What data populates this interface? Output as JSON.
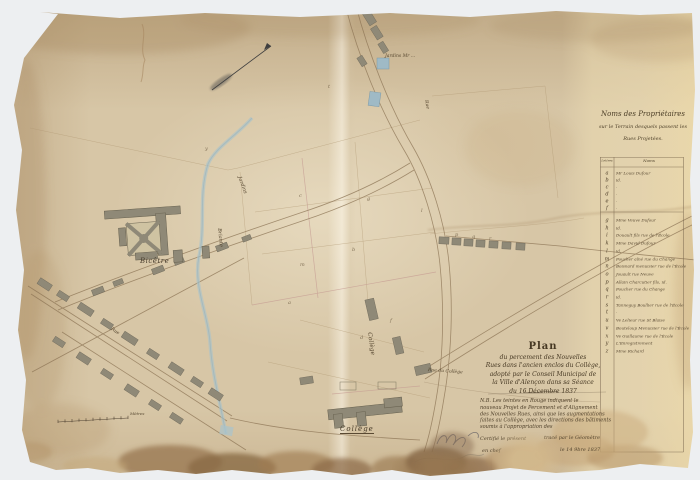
{
  "sheet": {
    "scale_label": "Mètres"
  },
  "colors": {
    "paper": "#d7c6a6",
    "ink": "#4a3c2c",
    "stream_blue": "#a9c3cc",
    "stain_brown": "#8a6a46",
    "building_gray": "#8f8977"
  },
  "title_block": {
    "l1": "Plan",
    "l2": "du percement des Nouvelles",
    "l3": "Rues dans l'ancien enclos du Collège,",
    "l4": "adopté par le Conseil Municipal de",
    "l5": "la Ville d'Alençon dans sa Séance",
    "l6": "du 16 Décembre 1837"
  },
  "note_block": {
    "lines": [
      "N.B. Les teintes en Rouge indiquent le",
      "nouveau Projet de Percement et d'Alignement",
      "des Nouvelles Rues, ainsi que les augmentations",
      "faites au Collège, avec les directions des bâtiments",
      "soumis à l'appropriation des"
    ]
  },
  "certification": {
    "l1a": "Certifié le présent",
    "l1b": "tracé par le Géomètre",
    "l2a": "en chef",
    "l2b": "le 14 9bre 1837"
  },
  "proprietors": {
    "heading1": "Noms des Propriétaires",
    "heading2": "sur le Terrain desquels passent les",
    "heading3": "Rues Projetées.",
    "col_letters": "Lettres",
    "col_names": "Noms",
    "rows": [
      {
        "letter": "a",
        "name": "Mr Louis Dufour"
      },
      {
        "letter": "b",
        "name": "id."
      },
      {
        "letter": "c",
        "name": "·"
      },
      {
        "letter": "d",
        "name": "·"
      },
      {
        "letter": "e",
        "name": "·"
      },
      {
        "letter": "f",
        "name": "·"
      },
      {
        "letter": "g",
        "name": "Mme Veuve Dufour"
      },
      {
        "letter": "h",
        "name": "id."
      },
      {
        "letter": "i",
        "name": "Douault fils rue de l'École"
      },
      {
        "letter": "k",
        "name": "Mme David Dufour"
      },
      {
        "letter": "l",
        "name": "id."
      },
      {
        "letter": "m",
        "name": "Foucher aîné rue du Change"
      },
      {
        "letter": "n",
        "name": "Boisnard menuisier rue de l'École"
      },
      {
        "letter": "o",
        "name": "Jouault rue Neuve"
      },
      {
        "letter": "p",
        "name": "Allain Charcutier fils, id."
      },
      {
        "letter": "q",
        "name": "Foucher rue du Change"
      },
      {
        "letter": "r",
        "name": "id."
      },
      {
        "letter": "s",
        "name": "Tanneguy Boullier rue de l'École"
      },
      {
        "letter": "t",
        "name": "·"
      },
      {
        "letter": "u",
        "name": "Ve Lelieur rue St Blaise"
      },
      {
        "letter": "v",
        "name": "Bouteloup Menuisier rue de l'École"
      },
      {
        "letter": "x",
        "name": "Ve Guillaume rue de l'École"
      },
      {
        "letter": "y",
        "name": "L'Enregistrement"
      },
      {
        "letter": "z",
        "name": "Mme Richard"
      }
    ]
  },
  "map_labels": {
    "bicetre": "Bicêtre",
    "college_script": "Collège",
    "college_bottom": "Collège",
    "jardin_top": "Jardins Mr ...",
    "briante": "Briante",
    "jardins_diag": "Jardins",
    "rue_r1": "Rue",
    "rue_bottom": "Rue du Collège",
    "rue_s1": "Rue"
  },
  "parcel_letters": [
    {
      "t": "y",
      "x": 205,
      "y": 146
    },
    {
      "t": "t",
      "x": 328,
      "y": 84
    },
    {
      "t": "c",
      "x": 299,
      "y": 193
    },
    {
      "t": "g",
      "x": 367,
      "y": 196
    },
    {
      "t": "l",
      "x": 421,
      "y": 208
    },
    {
      "t": "b",
      "x": 352,
      "y": 247
    },
    {
      "t": "m",
      "x": 300,
      "y": 262
    },
    {
      "t": "a",
      "x": 288,
      "y": 300
    },
    {
      "t": "p",
      "x": 455,
      "y": 232
    },
    {
      "t": "q",
      "x": 472,
      "y": 234
    },
    {
      "t": "r",
      "x": 489,
      "y": 236
    },
    {
      "t": "f",
      "x": 390,
      "y": 318
    },
    {
      "t": "d",
      "x": 360,
      "y": 335
    }
  ]
}
